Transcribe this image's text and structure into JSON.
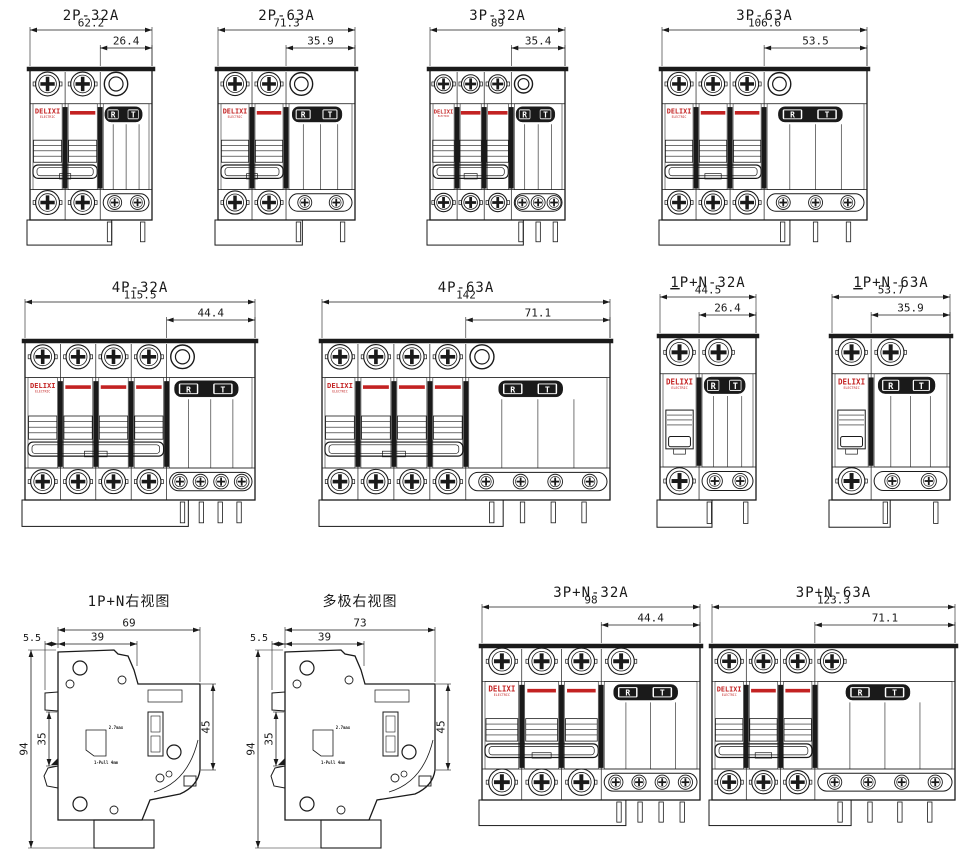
{
  "sheet": {
    "background": "#ffffff",
    "line_color": "#1a1a1a",
    "accent_red": "#c32222",
    "logo": {
      "name": "DELIXI",
      "sub": "ELECTRIC"
    },
    "rcd_buttons": {
      "reset": "R",
      "test": "T"
    }
  },
  "side_notes": {
    "note_top": "2.7max",
    "note_bottom": "1-Pull 4mm"
  },
  "diagrams": [
    {
      "id": "2p-32a",
      "title": "2P-32A",
      "view": "front",
      "poles": 2,
      "dim_total": "62.2",
      "dim_module": "26.4",
      "top_plain_circle": true,
      "top_extra_screw": false,
      "bottom_left_screws": 2,
      "oval_screws": 2,
      "pins": 2,
      "underline_first": false
    },
    {
      "id": "2p-63a",
      "title": "2P-63A",
      "view": "front",
      "poles": 2,
      "dim_total": "71.3",
      "dim_module": "35.9",
      "top_plain_circle": true,
      "top_extra_screw": false,
      "bottom_left_screws": 2,
      "oval_screws": 2,
      "pins": 2,
      "underline_first": false
    },
    {
      "id": "3p-32a",
      "title": "3P-32A",
      "view": "front",
      "poles": 3,
      "dim_total": "89",
      "dim_module": "35.4",
      "top_plain_circle": true,
      "top_extra_screw": false,
      "bottom_left_screws": 3,
      "oval_screws": 3,
      "pins": 3,
      "underline_first": false
    },
    {
      "id": "3p-63a",
      "title": "3P-63A",
      "view": "front",
      "poles": 3,
      "dim_total": "106.6",
      "dim_module": "53.5",
      "top_plain_circle": true,
      "top_extra_screw": false,
      "bottom_left_screws": 3,
      "oval_screws": 3,
      "pins": 3,
      "underline_first": false
    },
    {
      "id": "4p-32a",
      "title": "4P-32A",
      "view": "front",
      "poles": 4,
      "dim_total": "115.5",
      "dim_module": "44.4",
      "top_plain_circle": true,
      "top_extra_screw": false,
      "bottom_left_screws": 4,
      "oval_screws": 4,
      "pins": 4,
      "underline_first": false
    },
    {
      "id": "4p-63a",
      "title": "4P-63A",
      "view": "front",
      "poles": 4,
      "dim_total": "142",
      "dim_module": "71.1",
      "top_plain_circle": true,
      "top_extra_screw": false,
      "bottom_left_screws": 4,
      "oval_screws": 4,
      "pins": 4,
      "underline_first": false
    },
    {
      "id": "1pn-32a",
      "title": "1P+N-32A",
      "view": "front",
      "poles": 1,
      "dim_total": "44.5",
      "dim_module": "26.4",
      "top_plain_circle": false,
      "top_extra_screw": true,
      "bottom_left_screws": 1,
      "oval_screws": 2,
      "pins": 2,
      "underline_first": true
    },
    {
      "id": "1pn-63a",
      "title": "1P+N-63A",
      "view": "front",
      "poles": 1,
      "dim_total": "53.7",
      "dim_module": "35.9",
      "top_plain_circle": false,
      "top_extra_screw": true,
      "bottom_left_screws": 1,
      "oval_screws": 2,
      "pins": 2,
      "underline_first": true
    },
    {
      "id": "side-1pn",
      "title": "1P+N右视图",
      "view": "side",
      "dim_depth": "69",
      "dim_body": "39",
      "dim_clip": "5.5",
      "dim_height": "94",
      "dim_rail": "35",
      "dim_front": "45"
    },
    {
      "id": "side-multi",
      "title": "多极右视图",
      "view": "side",
      "dim_depth": "73",
      "dim_body": "39",
      "dim_clip": "5.5",
      "dim_height": "94",
      "dim_rail": "35",
      "dim_front": "45"
    },
    {
      "id": "3pn-32a",
      "title": "3P+N-32A",
      "view": "front",
      "poles": 3,
      "dim_total": "98",
      "dim_module": "44.4",
      "top_plain_circle": false,
      "top_extra_screw": true,
      "bottom_left_screws": 3,
      "oval_screws": 4,
      "pins": 4,
      "underline_first": false
    },
    {
      "id": "3pn-63a",
      "title": "3P+N-63A",
      "view": "front",
      "poles": 3,
      "dim_total": "123.3",
      "dim_module": "71.1",
      "top_plain_circle": false,
      "top_extra_screw": true,
      "bottom_left_screws": 3,
      "oval_screws": 4,
      "pins": 4,
      "underline_first": false
    }
  ]
}
